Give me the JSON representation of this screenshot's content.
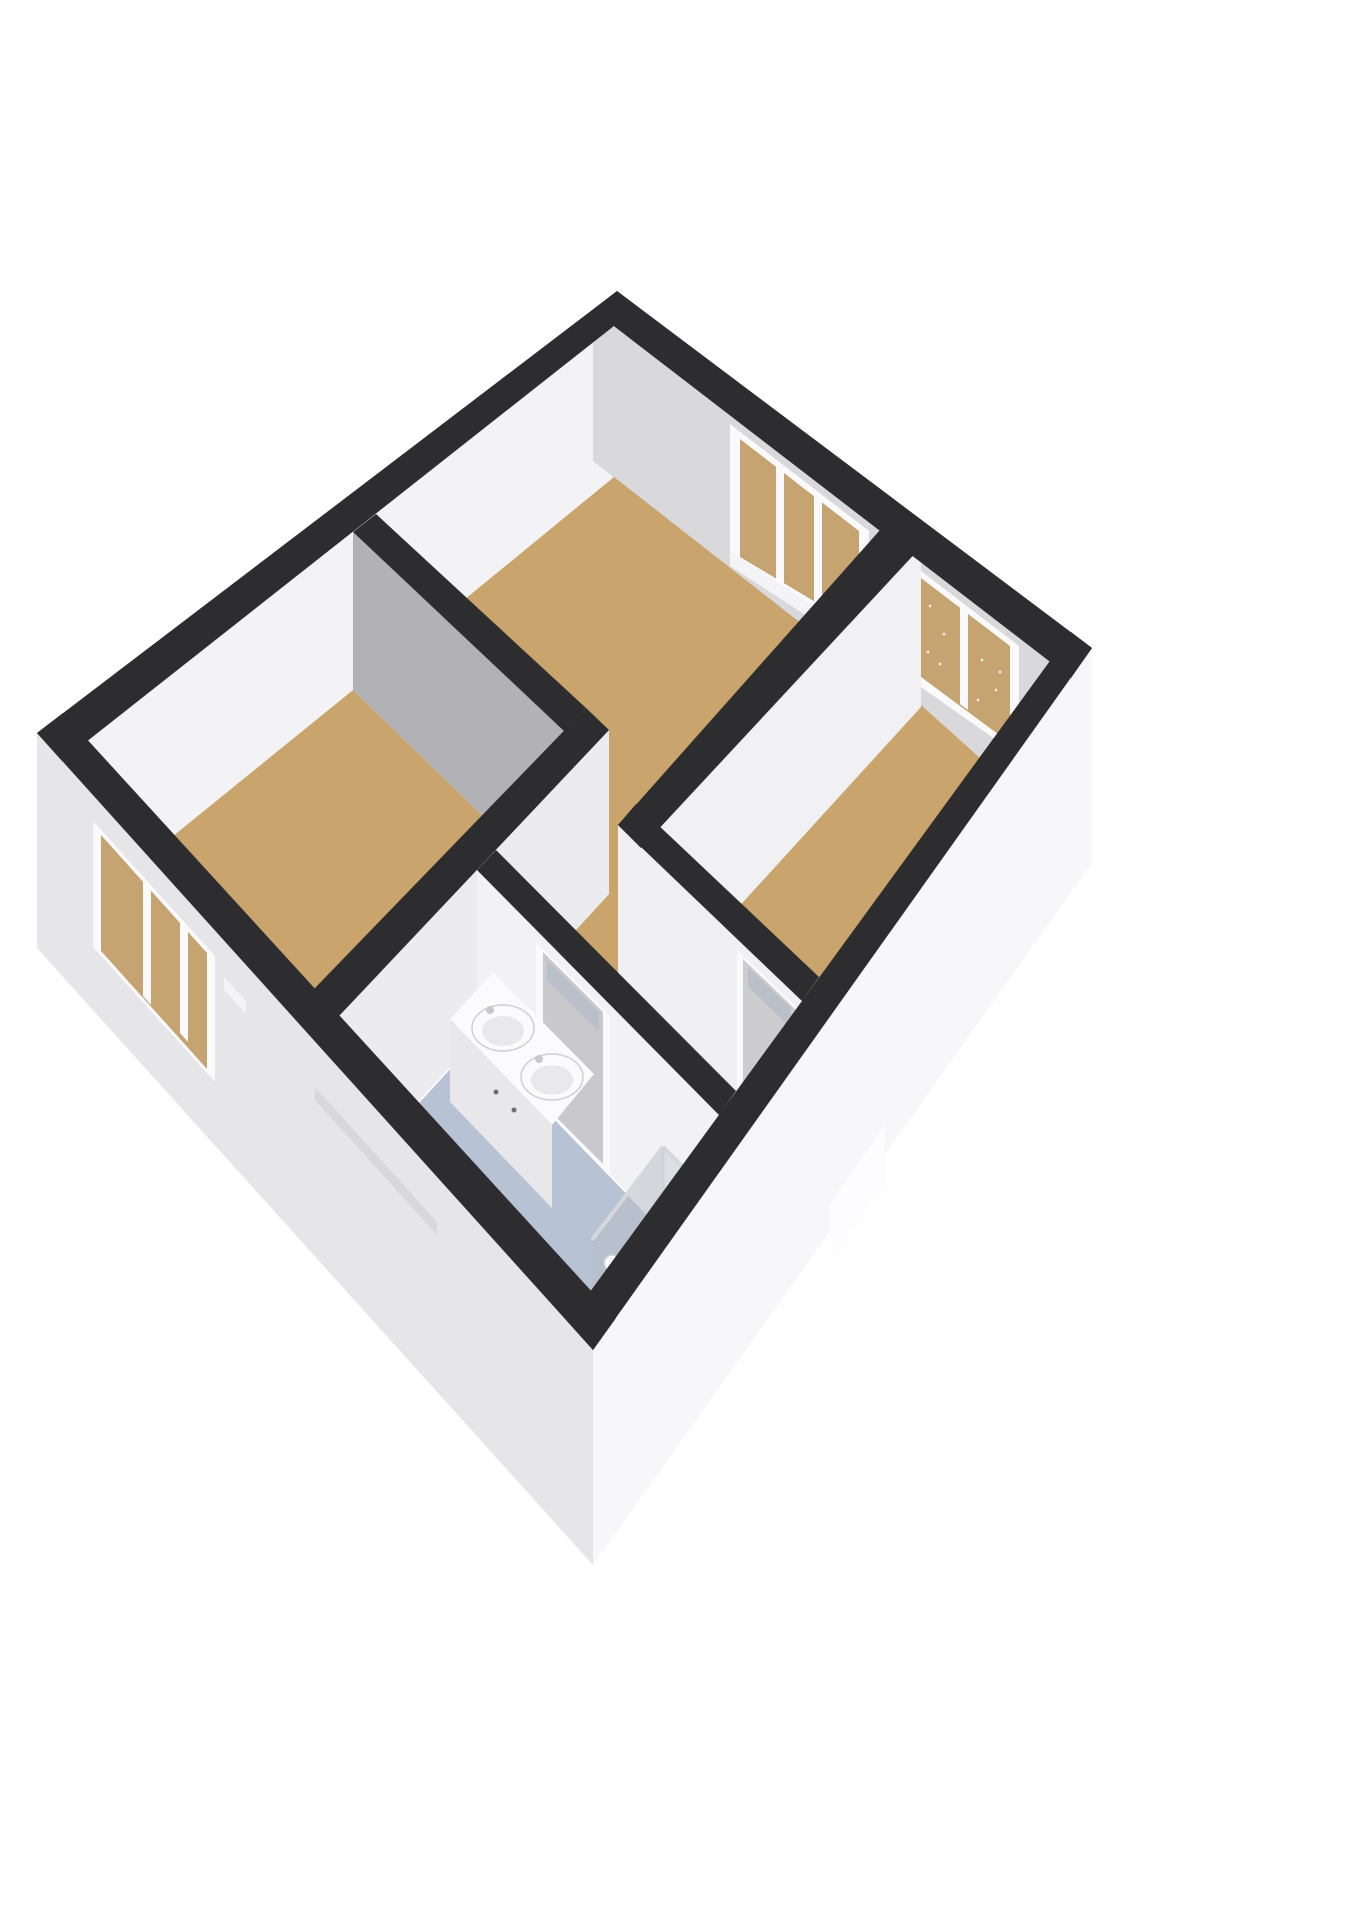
{
  "scene": {
    "type": "3d-floor-plan",
    "view": "isometric-top-down",
    "rooms_count": 5,
    "windows_count": 3,
    "doors_count": 2,
    "sinks_count": 2,
    "showers_count": 1
  },
  "colors": {
    "background": "#ffffff",
    "cap": "#2d2d2f",
    "wall_white": "#f3f3f5",
    "wall_bright": "#f1f1f3",
    "wall_lighter": "#ececee",
    "wall_face_w3": "#f0f0f2",
    "wall_face_w7": "#f2f2f4",
    "wall_gray": "#b2b2b6",
    "wall_midgray": "#d9d9db",
    "ext_sw": "#e6e6e8",
    "ext_se": "#f7f7f9",
    "floor": "#c9a46c",
    "floor_hall": "#c49e63",
    "floor_bath": "#b7c2d4",
    "glass_tan": "#c6a471",
    "glass_blue": "#b9c0ca",
    "frame_white": "#fafafc",
    "door_gray": "#c9c9cc",
    "door_gray2": "#cdcdd0",
    "handle": "#6e6e72",
    "fixture": "#fbfbfd",
    "fixture_shade": "#e8e8ea",
    "fixture_side": "#d9d9db",
    "chrome": "#d5d8db",
    "shower_glass": "#b9bfc7",
    "shower_glass2": "#c3c9d0",
    "shower_tray": "#9aa0a8",
    "shower_tray_dark": "#868b93",
    "groove": "#d8d8da",
    "wedge": "#fdfdff",
    "sill": "#f4f4f6",
    "speckle": "#ffffff",
    "faucet": "#c9c9cb",
    "sink_inner": "#e9e9eb"
  }
}
